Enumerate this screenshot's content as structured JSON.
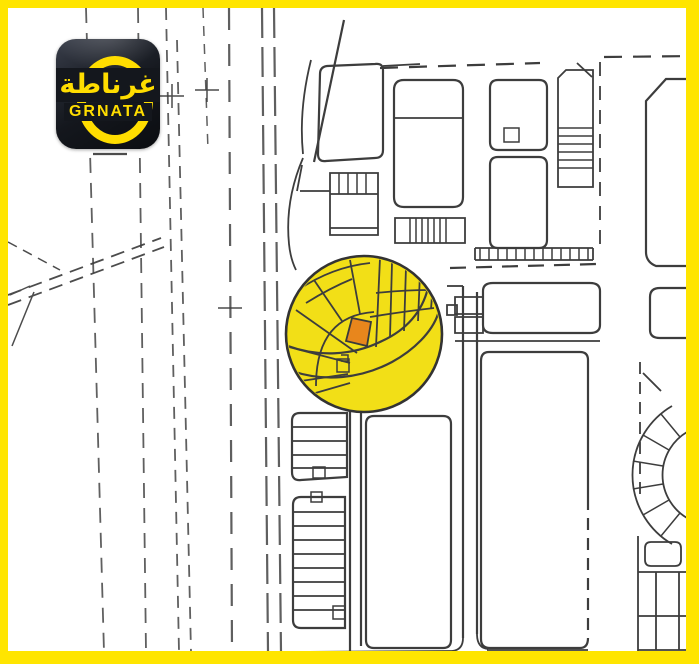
{
  "logo": {
    "arabic": "غرناطة",
    "latin": "GRNATA"
  },
  "colors": {
    "frame": "#FFE500",
    "map_bg": "#FFFFFF",
    "map_line": "#3D3D3D",
    "highlight_circle": "#F2DF17",
    "highlighted_plot": "#E8861C",
    "logo_bg": "#14171D",
    "logo_accent": "#FFDD00"
  }
}
